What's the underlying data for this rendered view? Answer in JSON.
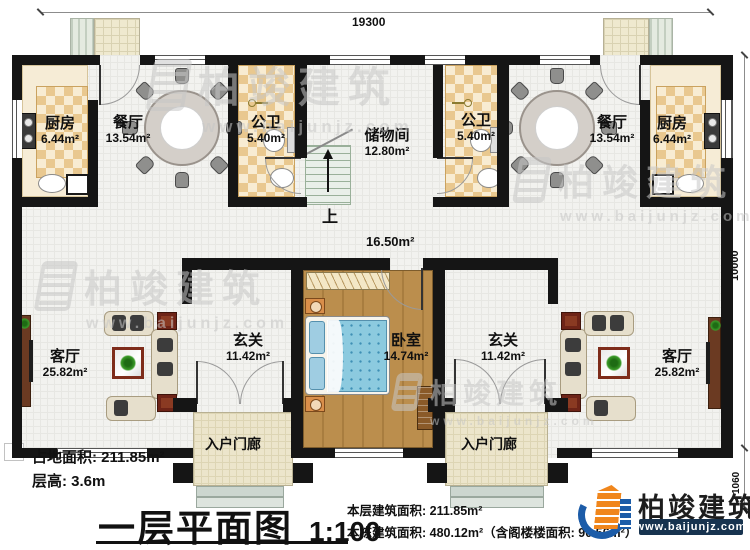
{
  "rooms": {
    "kitchen_left": {
      "name": "厨房",
      "area": "6.44m²"
    },
    "dining_left": {
      "name": "餐厅",
      "area": "13.54m²"
    },
    "bath_left": {
      "name": "公卫",
      "area": "5.40m²"
    },
    "storage": {
      "name": "储物间",
      "area": "12.80m²"
    },
    "bath_right": {
      "name": "公卫",
      "area": "5.40m²"
    },
    "dining_right": {
      "name": "餐厅",
      "area": "13.54m²"
    },
    "kitchen_right": {
      "name": "厨房",
      "area": "6.44m²"
    },
    "corridor": {
      "area": "16.50m²"
    },
    "living_left": {
      "name": "客厅",
      "area": "25.82m²"
    },
    "hall_left": {
      "name": "玄关",
      "area": "11.42m²"
    },
    "bedroom": {
      "name": "卧室",
      "area": "14.74m²"
    },
    "hall_right": {
      "name": "玄关",
      "area": "11.42m²"
    },
    "living_right": {
      "name": "客厅",
      "area": "25.82m²"
    },
    "porch_left": {
      "name": "入户门廊"
    },
    "porch_right": {
      "name": "入户门廊"
    }
  },
  "stairs": {
    "up_label": "上"
  },
  "dimensions": {
    "top": "19300",
    "right": "10000",
    "right_lower": "1060"
  },
  "watermark": {
    "brand": "柏竣建筑",
    "url": "www.baijunjz.com"
  },
  "footer": {
    "land_area": "占地面积: 211.85m²",
    "floor_height": "层高: 3.6m",
    "title": "一层平面图",
    "scale": "1:100",
    "floor_area_line": "本层建筑面积: 211.85m²",
    "building_area_line": "本栋建筑面积: 480.12m²（含阁楼楼面积: 90.56m²）"
  },
  "logo": {
    "brand": "柏竣建筑",
    "url": "www.baijunjz.com"
  },
  "colors": {
    "wall": "#151515",
    "checker_tile": "#e9c88f",
    "wood_floor": "#bb8e4d",
    "bed_blue": "#8ccadf",
    "logo_orange": "#f0861c",
    "logo_blue": "#1c5ca8",
    "logo_bar_navy": "#17334f"
  }
}
